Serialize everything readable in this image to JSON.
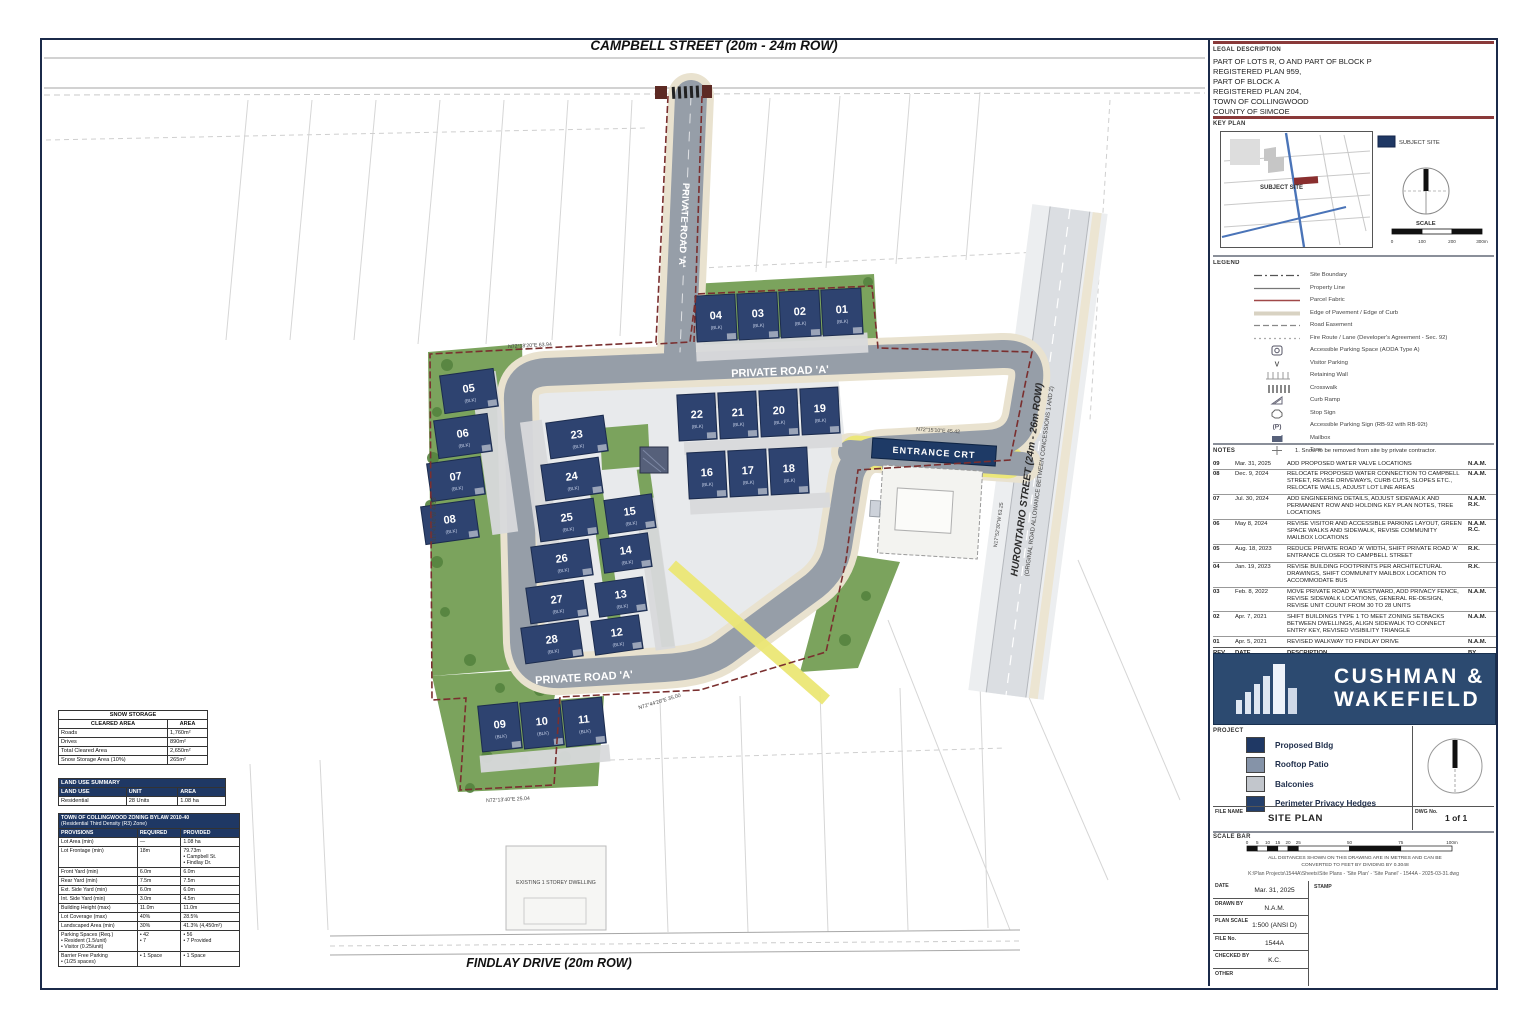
{
  "streets": {
    "campbell": "CAMPBELL STREET (20m - 24m ROW)",
    "findlay": "FINDLAY DRIVE (20m ROW)",
    "hurontario_line1": "HURONTARIO STREET (24m - 26m ROW)",
    "hurontario_line2": "(ORIGINAL ROAD ALLOWANCE BETWEEN CONCESSIONS 1 AND 2)",
    "private_road": "PRIVATE ROAD 'A'",
    "entrance_sign": "ENTRANCE CRT"
  },
  "plan": {
    "units": [
      "04",
      "03",
      "02",
      "01",
      "05",
      "06",
      "07",
      "08",
      "23",
      "24",
      "25",
      "26",
      "27",
      "28",
      "15",
      "14",
      "13",
      "12",
      "22",
      "21",
      "20",
      "19",
      "16",
      "17",
      "18",
      "09",
      "10",
      "11"
    ],
    "unit_sub": "(BLK)",
    "dims": [
      "N72°18'20\"E  63.94",
      "N17°41'40\"W  42.28",
      "N72°15'10\"E  45.42",
      "N17°52'30\"W  63.25",
      "N72°13'40\"E  25.04",
      "N72°44'20\"E  35.00",
      "EXISTING 1 STOREY DWELLING"
    ]
  },
  "tables": {
    "snow": {
      "title": "SNOW STORAGE",
      "headers": [
        "CLEARED AREA",
        "AREA"
      ],
      "rows": [
        [
          "Roads",
          "1,760m²"
        ],
        [
          "Drives",
          "890m²"
        ],
        [
          "Total Cleared Area",
          "2,650m²"
        ],
        [
          "Snow Storage Area (10%)",
          "265m²"
        ]
      ]
    },
    "land_use": {
      "title": "LAND USE SUMMARY",
      "headers": [
        "LAND USE",
        "UNIT",
        "AREA"
      ],
      "rows": [
        [
          "Residential",
          "28 Units",
          "1.08 ha"
        ]
      ]
    },
    "zoning": {
      "title1": "TOWN OF COLLINGWOOD ZONING BYLAW 2010-40",
      "title2": "(Residential Third Density (R3) Zone)",
      "headers": [
        "PROVISIONS",
        "REQUIRED",
        "PROVIDED"
      ],
      "rows": [
        [
          "Lot Area (min)",
          "—",
          "1.08 ha"
        ],
        [
          "Lot Frontage (min)",
          "18m",
          "79.73m\n• Campbell St.\n• Findlay Dr."
        ],
        [
          "Front Yard (min)",
          "6.0m",
          "6.0m"
        ],
        [
          "Rear Yard (min)",
          "7.5m",
          "7.5m"
        ],
        [
          "Ext. Side Yard (min)",
          "6.0m",
          "6.0m"
        ],
        [
          "Int. Side Yard (min)",
          "3.0m",
          "4.5m"
        ],
        [
          "Building Height (max)",
          "11.0m",
          "11.0m"
        ],
        [
          "Lot Coverage (max)",
          "40%",
          "28.5%"
        ],
        [
          "Landscaped Area (min)",
          "30%",
          "41.3% (4,450m²)"
        ],
        [
          "Parking Spaces (Req.)\n• Resident (1.5/unit)\n• Visitor (0.25/unit)",
          "• 42\n• 7",
          "• 56\n• 7 Provided"
        ],
        [
          "Barrier Free Parking\n• (1/25 spaces)",
          "• 1 Space",
          "• 1 Space"
        ]
      ]
    }
  },
  "right_panel": {
    "legal": {
      "heading": "LEGAL DESCRIPTION",
      "lines": [
        "PART OF LOTS R, O AND PART OF BLOCK P",
        "REGISTERED PLAN 959,",
        "PART OF BLOCK A",
        "REGISTERED PLAN 204,",
        "TOWN OF COLLINGWOOD",
        "COUNTY OF SIMCOE"
      ]
    },
    "key_plan": {
      "heading": "KEY PLAN",
      "chip_label": "SUBJECT SITE",
      "map_label": "SUBJECT SITE",
      "scale_label": "SCALE",
      "ticks": [
        "0",
        "100",
        "200",
        "300m"
      ]
    },
    "legend": {
      "heading": "LEGEND",
      "items": [
        {
          "icon": "dash-dot-line",
          "label": "Site Boundary"
        },
        {
          "icon": "solid-line",
          "label": "Property Line"
        },
        {
          "icon": "red-line",
          "label": "Parcel Fabric"
        },
        {
          "icon": "pale-line",
          "label": "Edge of Pavement / Edge of Curb"
        },
        {
          "icon": "dashed-line",
          "label": "Road Easement"
        },
        {
          "icon": "dotted-line",
          "label": "Fire Route / Lane (Developer's Agreement - Sec. 92)"
        },
        {
          "icon": "accessible-space",
          "label": "Accessible Parking Space (AODA Type A)"
        },
        {
          "icon": "v-marker",
          "label": "Visitor Parking"
        },
        {
          "icon": "retaining-wall",
          "label": "Retaining Wall"
        },
        {
          "icon": "crosswalk",
          "label": "Crosswalk"
        },
        {
          "icon": "curb-ramp",
          "label": "Curb Ramp"
        },
        {
          "icon": "stop-sign",
          "label": "Stop Sign"
        },
        {
          "icon": "parking-sign",
          "label": "Accessible Parking Sign (RB-92 with RB-92t)"
        },
        {
          "icon": "mailbox",
          "label": "Mailbox"
        },
        {
          "icon": "tree",
          "label": "Tree"
        }
      ]
    },
    "notes": {
      "heading": "NOTES",
      "text": "1. Snow to be removed from site by private contractor."
    },
    "revisions": {
      "header": {
        "rev": "REV No.",
        "date": "DATE",
        "desc": "DESCRIPTION",
        "by": "BY"
      },
      "rows": [
        {
          "rev": "09",
          "date": "Mar. 31, 2025",
          "desc": "ADD PROPOSED WATER VALVE LOCATIONS",
          "by": "N.A.M."
        },
        {
          "rev": "08",
          "date": "Dec. 9, 2024",
          "desc": "RELOCATE PROPOSED WATER CONNECTION TO CAMPBELL STREET, REVISE DRIVEWAYS, CURB CUTS, SLOPES ETC., RELOCATE WALLS, ADJUST LOT LINE AREAS",
          "by": "N.A.M."
        },
        {
          "rev": "07",
          "date": "Jul. 30, 2024",
          "desc": "ADD ENGINEERING DETAILS, ADJUST SIDEWALK AND PERMANENT ROW AND HOLDING KEY PLAN NOTES, TREE LOCATIONS",
          "by": "N.A.M. R.K."
        },
        {
          "rev": "06",
          "date": "May 8, 2024",
          "desc": "REVISE VISITOR AND ACCESSIBLE PARKING LAYOUT, GREEN SPACE WALKS AND SIDEWALK, REVISE COMMUNITY MAILBOX LOCATIONS",
          "by": "N.A.M. R.C."
        },
        {
          "rev": "05",
          "date": "Aug. 18, 2023",
          "desc": "REDUCE PRIVATE ROAD 'A' WIDTH, SHIFT PRIVATE ROAD 'A' ENTRANCE CLOSER TO CAMPBELL STREET",
          "by": "R.K."
        },
        {
          "rev": "04",
          "date": "Jan. 19, 2023",
          "desc": "REVISE BUILDING FOOTPRINTS PER ARCHITECTURAL DRAWINGS, SHIFT COMMUNITY MAILBOX LOCATION TO ACCOMMODATE BUS",
          "by": "R.K."
        },
        {
          "rev": "03",
          "date": "Feb. 8, 2022",
          "desc": "MOVE PRIVATE ROAD 'A' WESTWARD, ADD PRIVACY FENCE, REVISE SIDEWALK LOCATIONS, GENERAL RE-DESIGN, REVISE UNIT COUNT FROM 30 TO 28 UNITS",
          "by": "N.A.M."
        },
        {
          "rev": "02",
          "date": "Apr. 7, 2021",
          "desc": "SHIFT BUILDINGS TYPE 1 TO MEET ZONING SETBACKS BETWEEN DWELLINGS, ALIGN SIDEWALK TO CONNECT ENTRY KEY, REVISED VISIBILITY TRIANGLE",
          "by": "N.A.M."
        },
        {
          "rev": "01",
          "date": "Apr. 5, 2021",
          "desc": "REVISED WALKWAY TO FINDLAY DRIVE",
          "by": "N.A.M."
        }
      ]
    },
    "logo": {
      "line1": "CUSHMAN &",
      "line2": "WAKEFIELD"
    },
    "project": {
      "heading": "PROJECT",
      "items": [
        {
          "color": "#1f3864",
          "label": "Proposed Bldg"
        },
        {
          "color": "#8593a8",
          "label": "Rooftop Patio"
        },
        {
          "color": "#c2c6cc",
          "label": "Balconies"
        },
        {
          "color": "#243f6b",
          "label": "Perimeter Privacy Hedges"
        }
      ]
    },
    "file_name": {
      "label": "FILE NAME",
      "value": "SITE PLAN"
    },
    "dwg": {
      "label": "DWG No.",
      "value": "1 of 1"
    },
    "scale_bar": {
      "label": "SCALE BAR",
      "ticks": [
        "0",
        "5",
        "10",
        "15",
        "20",
        "25",
        "50",
        "75",
        "100m"
      ],
      "note1": "ALL DISTANCES SHOWN ON THIS DRAWING ARE IN METRES AND CAN BE",
      "note2": "CONVERTED TO FEET BY DIVIDING BY 0.3048",
      "path": "K:\\Plan Projects\\1544A\\Sheets\\Site Plans - 'Site Plan' - 'Site Panel' - 1544A - 2025-03-31.dwg"
    },
    "info": {
      "date_label": "DATE",
      "date": "Mar. 31, 2025",
      "drawn_label": "DRAWN BY",
      "drawn": "N.A.M.",
      "scale_label": "PLAN SCALE",
      "scale": "1:500 (ANSI D)",
      "file_label": "FILE No.",
      "file": "1544A",
      "checked_label": "CHECKED BY",
      "checked": "K.C.",
      "other_label": "OTHER",
      "other": "",
      "stamp_label": "STAMP"
    }
  }
}
